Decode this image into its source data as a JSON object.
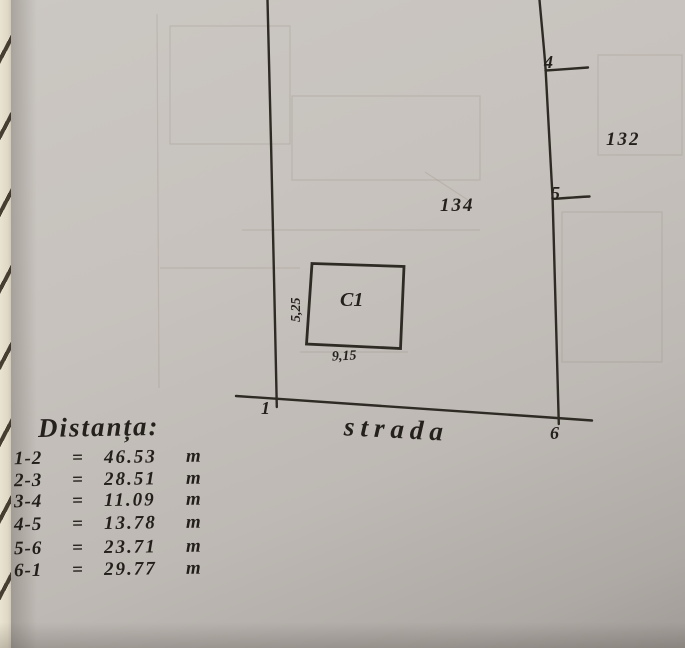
{
  "page": {
    "description": "Hand-drawn cadastral parcel sketch on notebook page",
    "paper_hex": "#c7c2bd",
    "ink_hex": "#2e2a24",
    "edge_strip_hex": "#e0d9c6"
  },
  "plan": {
    "street_label": "strada",
    "parcel_label": "134",
    "adjacent_parcel_label": "132",
    "building": {
      "label": "C1",
      "front_dimension": "9,15",
      "side_dimension": "5,25"
    },
    "points": {
      "p1": "1",
      "p4": "4",
      "p5": "5",
      "p6": "6"
    }
  },
  "distances": {
    "title": "Distanța:",
    "rows": [
      {
        "segment": "1-2",
        "eq": "=",
        "value": "46.53",
        "unit": "m"
      },
      {
        "segment": "2-3",
        "eq": "=",
        "value": "28.51",
        "unit": "m"
      },
      {
        "segment": "3-4",
        "eq": "=",
        "value": "11.09",
        "unit": "m"
      },
      {
        "segment": "4-5",
        "eq": "=",
        "value": "13.78",
        "unit": "m"
      },
      {
        "segment": "5-6",
        "eq": "=",
        "value": "23.71",
        "unit": "m"
      },
      {
        "segment": "6-1",
        "eq": "=",
        "value": "29.77",
        "unit": "m"
      }
    ]
  }
}
